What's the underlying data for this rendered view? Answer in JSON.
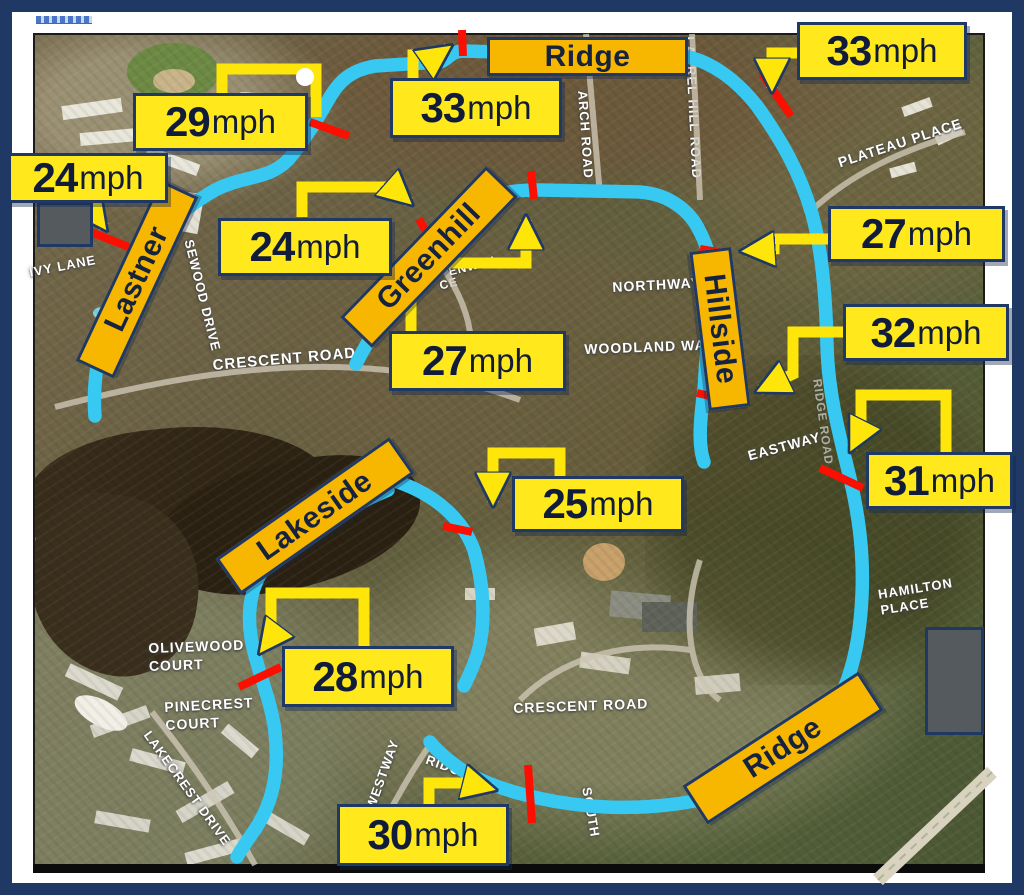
{
  "speed_callouts": [
    {
      "value": "29",
      "unit": "mph"
    },
    {
      "value": "24",
      "unit": "mph"
    },
    {
      "value": "33",
      "unit": "mph"
    },
    {
      "value": "33",
      "unit": "mph"
    },
    {
      "value": "24",
      "unit": "mph"
    },
    {
      "value": "27",
      "unit": "mph"
    },
    {
      "value": "32",
      "unit": "mph"
    },
    {
      "value": "31",
      "unit": "mph"
    },
    {
      "value": "27",
      "unit": "mph"
    },
    {
      "value": "25",
      "unit": "mph"
    },
    {
      "value": "28",
      "unit": "mph"
    },
    {
      "value": "30",
      "unit": "mph"
    }
  ],
  "street_signs": [
    {
      "label": "Ridge"
    },
    {
      "label": "Lastner"
    },
    {
      "label": "Greenhill"
    },
    {
      "label": "Hillside"
    },
    {
      "label": "Lakeside"
    },
    {
      "label": "Ridge"
    }
  ],
  "street_names": [
    {
      "text": "IVY LANE"
    },
    {
      "text": "SEWOOD DRIVE"
    },
    {
      "text": "CRESCENT ROAD"
    },
    {
      "text": "NORTHWAY"
    },
    {
      "text": "WOODLAND WAY"
    },
    {
      "text": "ENWAY"
    },
    {
      "text": "CE"
    },
    {
      "text": "ARCH ROAD"
    },
    {
      "text": "LAUREL HILL ROAD"
    },
    {
      "text": "PLATEAU PLACE"
    },
    {
      "text": "EASTWAY"
    },
    {
      "text": "RIDGE ROAD"
    },
    {
      "text": "HAMILTON\nPLACE"
    },
    {
      "text": "OLIVEWOOD\nCOURT"
    },
    {
      "text": "PINECREST\nCOURT"
    },
    {
      "text": "LAKECREST DRIVE"
    },
    {
      "text": "WESTWAY"
    },
    {
      "text": "RIDGE RO"
    },
    {
      "text": "CRESCENT ROAD"
    },
    {
      "text": "SOUTH"
    }
  ],
  "colors": {
    "route": "#38C9F3",
    "callout_fill": "#FFE81C",
    "callout_border": "#1F3864",
    "sign_fill": "#F7B600",
    "measurement_marker": "#FA0F00",
    "frame": "#1F3864"
  }
}
